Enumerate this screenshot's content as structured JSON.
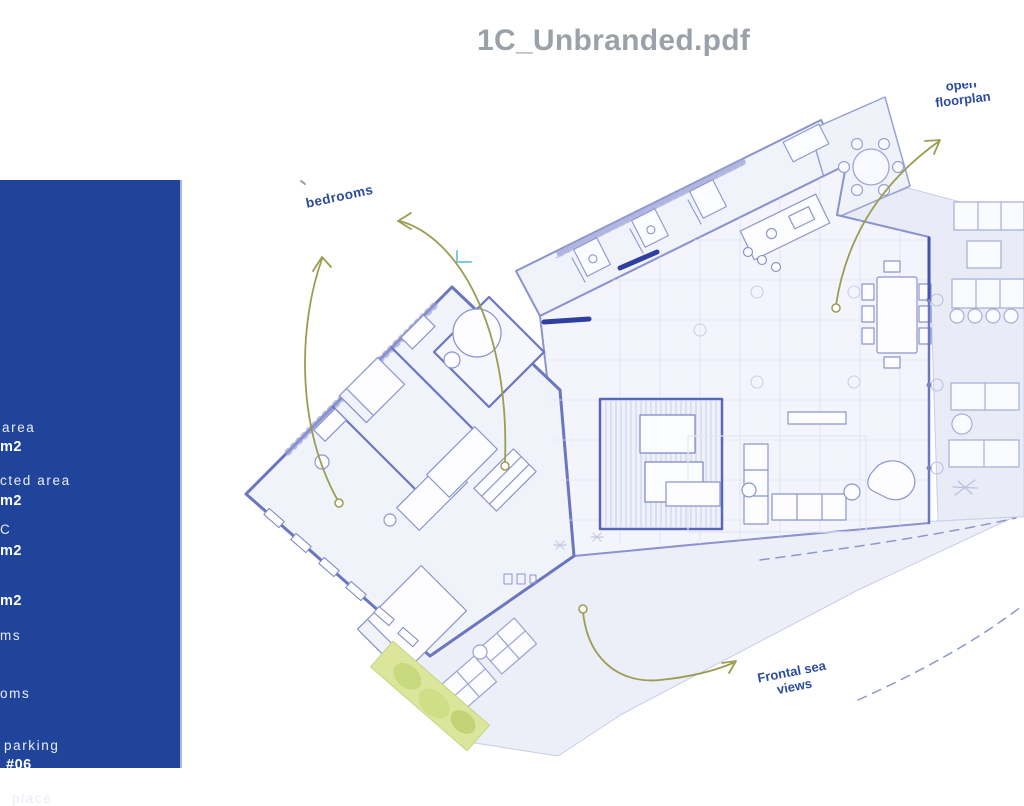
{
  "title": "1C_Unbranded.pdf",
  "sidebar": {
    "fragments": [
      {
        "text": "area",
        "style": "regular"
      },
      {
        "text": "m2",
        "style": "bold"
      },
      {
        "text": "cted area",
        "style": "regular"
      },
      {
        "text": "m2",
        "style": "bold"
      },
      {
        "text": "C",
        "style": "regular"
      },
      {
        "text": "m2",
        "style": "bold"
      },
      {
        "text": "m2",
        "style": "bold"
      },
      {
        "text": "ms",
        "style": "regular"
      },
      {
        "text": "oms",
        "style": "regular"
      },
      {
        "text": "parking",
        "style": "regular"
      },
      {
        "text": "#06",
        "style": "bold"
      },
      {
        "text": "place",
        "style": "regular"
      }
    ]
  },
  "plan": {
    "labels": {
      "bedrooms": "bedrooms",
      "open_floorplan_line1": "open",
      "open_floorplan_line2": "floorplan",
      "sea_views_line1": "Frontal sea",
      "sea_views_line2": "views"
    }
  },
  "colors": {
    "sidebar_blue": "#1f4499",
    "title_gray": "#9aa1a9",
    "annotation_navy": "#2b4c9e",
    "arrow_olive": "#9c9c52",
    "wall_blue": "#6a76bd",
    "dark_wall": "#2f3f9f",
    "planter_green": "#d9e59b"
  }
}
